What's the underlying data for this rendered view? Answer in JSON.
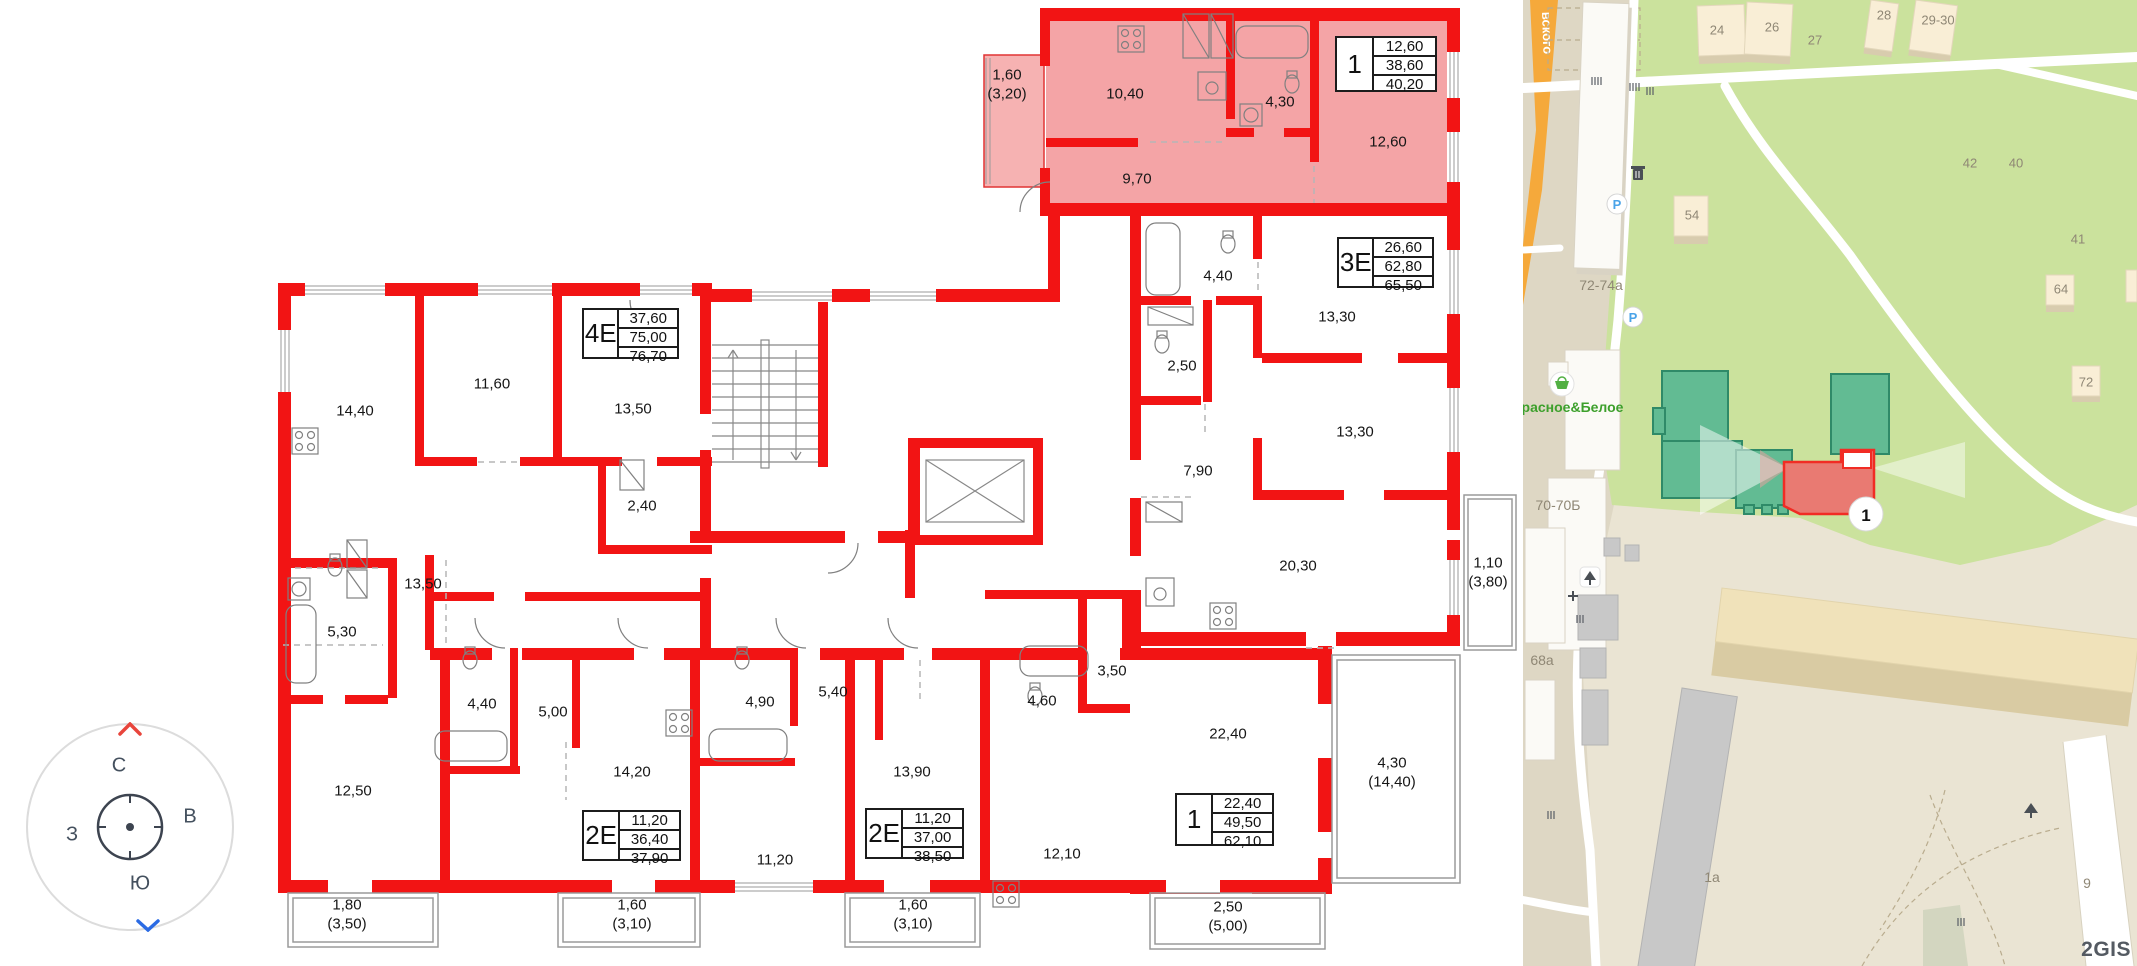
{
  "plan": {
    "info_boxes": [
      {
        "type": "1",
        "values": [
          "12,60",
          "38,60",
          "40,20"
        ]
      },
      {
        "type": "4Е",
        "values": [
          "37,60",
          "75,00",
          "76,70"
        ]
      },
      {
        "type": "3Е",
        "values": [
          "26,60",
          "62,80",
          "65,50"
        ]
      },
      {
        "type": "2Е",
        "values": [
          "11,20",
          "36,40",
          "37,90"
        ]
      },
      {
        "type": "2Е",
        "values": [
          "11,20",
          "37,00",
          "38,50"
        ]
      },
      {
        "type": "1",
        "values": [
          "22,40",
          "49,50",
          "62,10"
        ]
      }
    ],
    "room_labels": [
      "1,60\n(3,20)",
      "10,40",
      "4,30",
      "12,60",
      "9,70",
      "14,40",
      "11,60",
      "13,50",
      "2,40",
      "4,40",
      "2,50",
      "13,30",
      "13,30",
      "7,90",
      "20,30",
      "1,10\n(3,80)",
      "13,50",
      "5,30",
      "12,50",
      "4,40",
      "5,00",
      "14,20",
      "11,20",
      "4,90",
      "5,40",
      "13,90",
      "4,60",
      "12,10",
      "3,50",
      "22,40",
      "4,30\n(14,40)",
      "1,80\n(3,50)",
      "1,60\n(3,10)",
      "1,60\n(3,10)",
      "2,50\n(5,00)"
    ],
    "compass": {
      "n": "С",
      "s": "Ю",
      "w": "З",
      "e": "В"
    }
  },
  "map": {
    "street_name": "вского",
    "store": "Красное&Белое",
    "marker": "1",
    "parking_label": "P",
    "watermark": "2GIS",
    "labels": [
      "24",
      "26",
      "27",
      "28",
      "29-30",
      "42",
      "40",
      "41",
      "64",
      "72",
      "54",
      "72-74а",
      "70-70Б",
      "68а",
      "1а",
      "9"
    ],
    "colors": {
      "wall_red": "#f21414",
      "highlight_pink": "#f29496",
      "park_green": "#cbe29d",
      "road_orange": "#f5a93b",
      "building_teal": "#62bb93",
      "building_red": "#e97a72",
      "store_green": "#3da02c"
    }
  }
}
